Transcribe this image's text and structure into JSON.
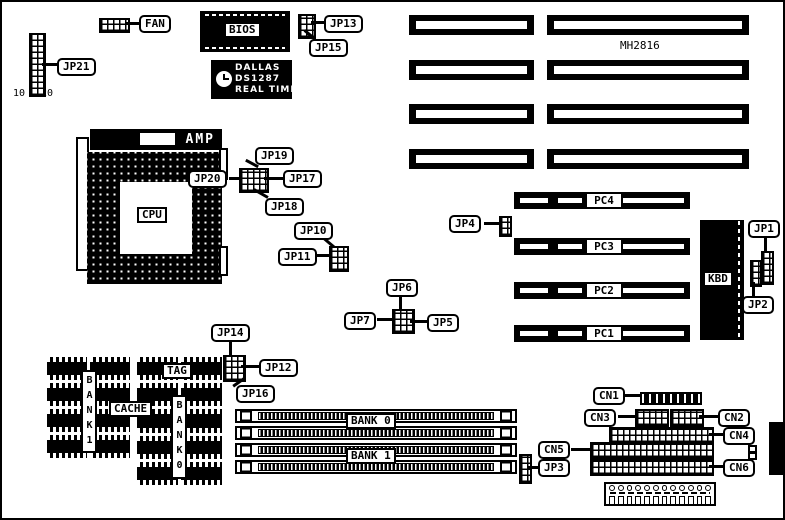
{
  "colors": {
    "foreground": "#000000",
    "background": "#ffffff"
  },
  "board": {
    "model": "MH2816"
  },
  "chips": {
    "bios": "BIOS",
    "dallas_line1": "DALLAS",
    "dallas_line2": "DS1287",
    "dallas_line3": "REAL TIME",
    "amp": "AMP",
    "cpu": "CPU",
    "kbd": "KBD"
  },
  "callouts": {
    "fan": "FAN",
    "jp21": "JP21",
    "jp13": "JP13",
    "jp15": "JP15",
    "jp19": "JP19",
    "jp20": "JP20",
    "jp17": "JP17",
    "jp18": "JP18",
    "jp10": "JP10",
    "jp11": "JP11",
    "jp4": "JP4",
    "jp1": "JP1",
    "jp2": "JP2",
    "jp6": "JP6",
    "jp7": "JP7",
    "jp5": "JP5",
    "jp14": "JP14",
    "jp12": "JP12",
    "jp16": "JP16",
    "jp3": "JP3",
    "cn1": "CN1",
    "cn2": "CN2",
    "cn3": "CN3",
    "cn4": "CN4",
    "cn5": "CN5",
    "cn6": "CN6"
  },
  "pci_slots": [
    "PC4",
    "PC3",
    "PC2",
    "PC1"
  ],
  "memory": {
    "bank0": "BANK 0",
    "bank1": "BANK 1"
  },
  "cache": {
    "tag": "TAG",
    "cache": "CACHE",
    "bank1_vertical": "BANK1",
    "bank0_vertical": "BANK0"
  },
  "jp21_pin_labels": {
    "first": "10",
    "last": "20"
  }
}
